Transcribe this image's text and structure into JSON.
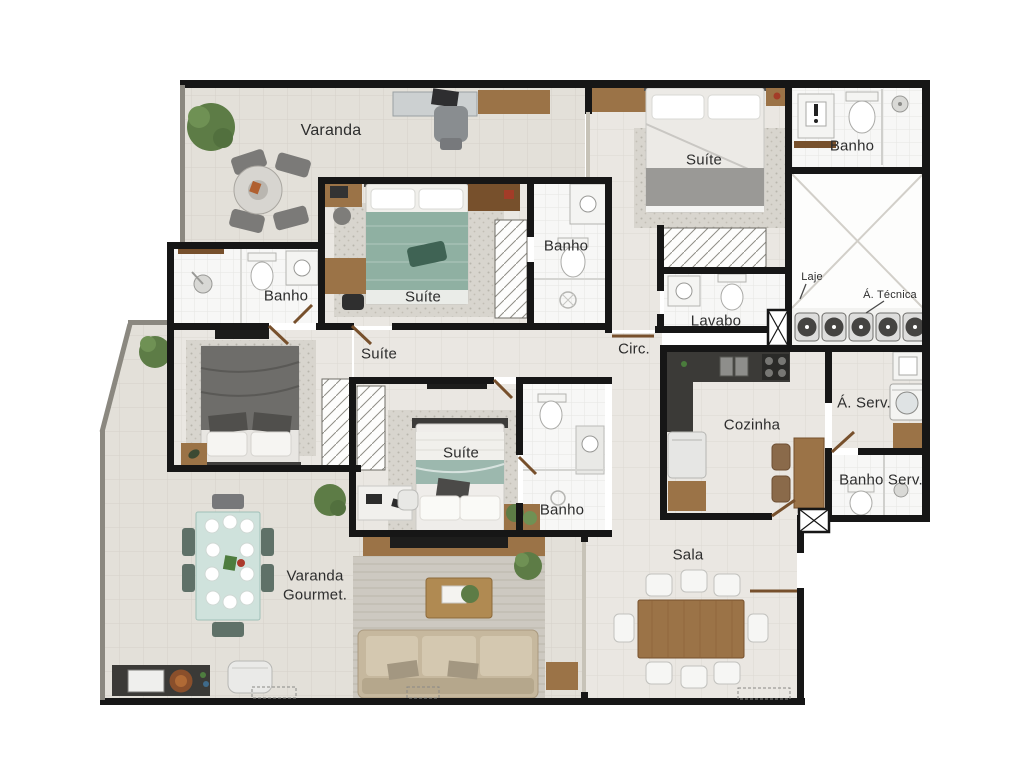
{
  "palette": {
    "wall": "#161616",
    "parapet": "#8b8880",
    "floor_interior": "#eae7e2",
    "floor_balcony": "#e3e0d9",
    "floor_bath": "#f7f7f6",
    "wood": "#9b7347",
    "wood_dark": "#77502c",
    "granite": "#3b3a37",
    "bed_green": "#8fb0a2",
    "bed_teal": "#9cb8ae",
    "bed_gray": "#6e6d6a",
    "sofa": "#c6b89e",
    "rug": "#cdc9c1",
    "plant": "#5d7c46",
    "table_teal": "#cfe2dc",
    "label": "#2d2d2d"
  },
  "labels": {
    "varanda": "Varanda",
    "banho_left": "Banho",
    "suite_top": "Suíte",
    "banho_top": "Banho",
    "suite_right": "Suíte",
    "banho_right": "Banho",
    "laje": "Laje",
    "a_tecnica": "Á. Técnica",
    "lavabo": "Lavabo",
    "circ": "Circ.",
    "suite_left": "Suíte",
    "suite_middle": "Suíte",
    "banho_middle": "Banho",
    "cozinha": "Cozinha",
    "a_serv": "Á. Serv.",
    "banho_serv": "Banho Serv.",
    "sala": "Sala",
    "varanda_gourmet": "Varanda Gourmet."
  }
}
